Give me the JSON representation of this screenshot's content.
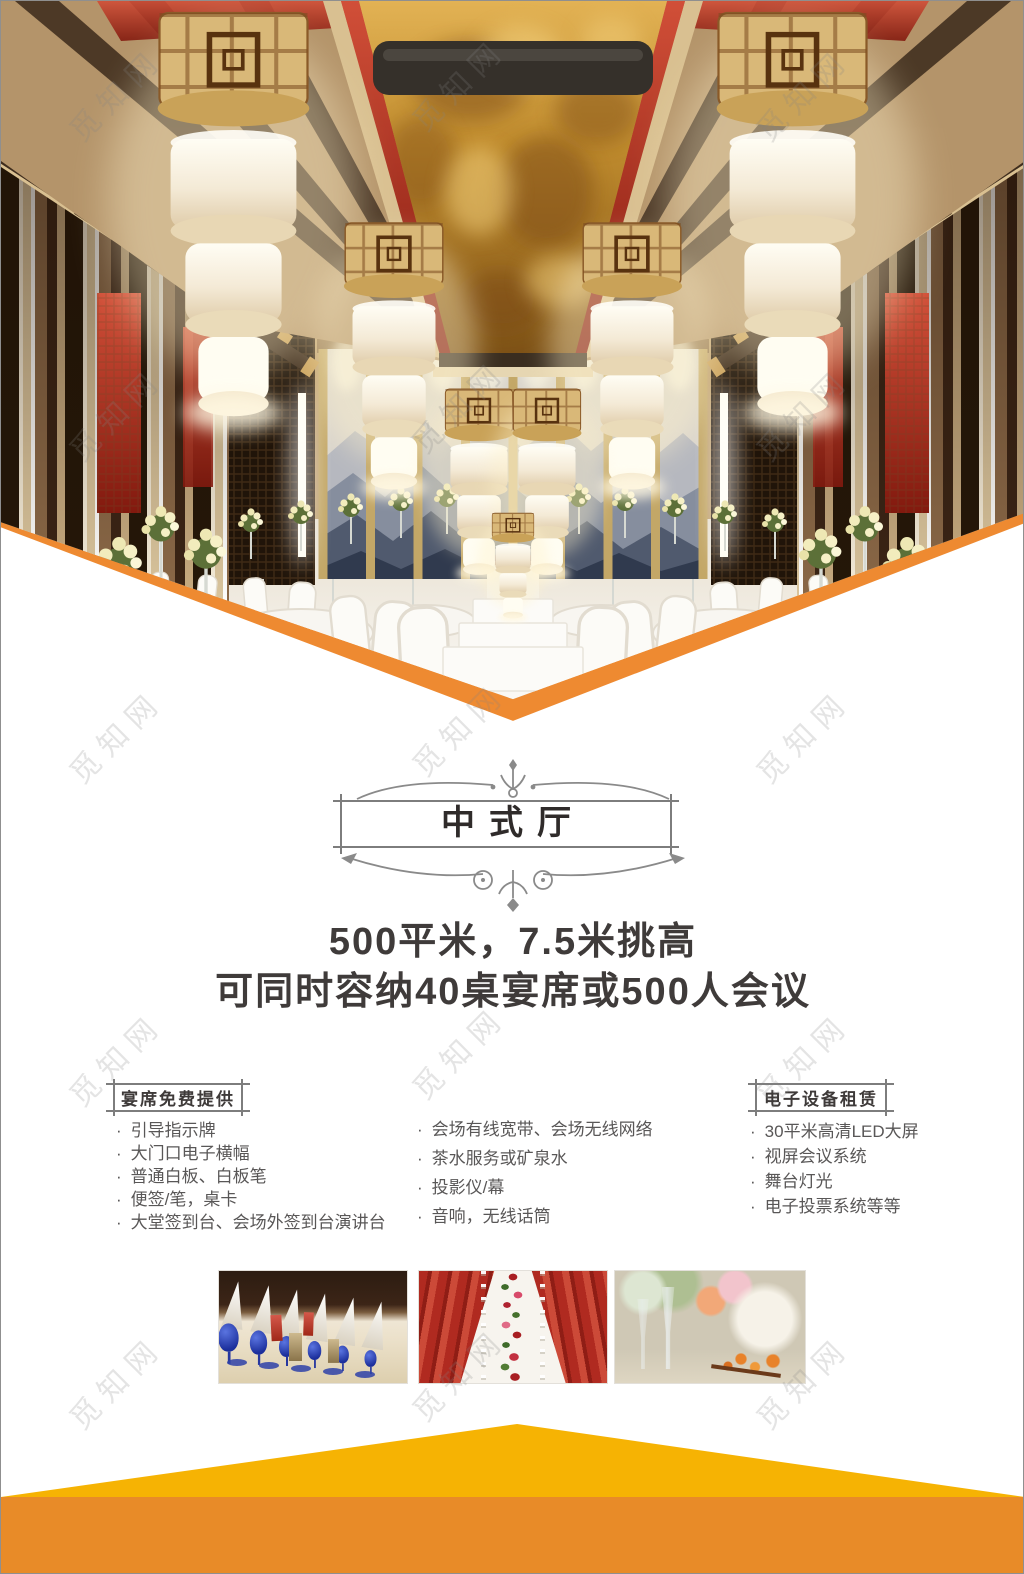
{
  "watermark": {
    "text": "觅知网"
  },
  "hero": {
    "image": "banquet-hall-ceiling-lanterns-photo"
  },
  "title_box": {
    "title": "中式厅"
  },
  "headline": {
    "line1": "500平米，7.5米挑高",
    "line2": "可同时容纳40桌宴席或500人会议"
  },
  "list_bullet": "·",
  "columns": {
    "free": {
      "header": "宴席免费提供",
      "items": [
        "引导指示牌",
        "大门口电子横幅",
        "普通白板、白板笔",
        "便签/笔，桌卡",
        "大堂签到台、会场外签到台演讲台"
      ]
    },
    "services": {
      "items": [
        "会场有线宽带、会场无线网络",
        "茶水服务或矿泉水",
        "投影仪/幕",
        "音响，无线话筒"
      ]
    },
    "rental": {
      "header": "电子设备租赁",
      "items": [
        "30平米高清LED大屏",
        "视屏会议系统",
        "舞台灯光",
        "电子投票系统等等"
      ]
    }
  },
  "gallery": {
    "photos": [
      {
        "name": "blue-goblet-table-setting-photo"
      },
      {
        "name": "red-chairs-floral-runner-photo"
      },
      {
        "name": "floral-centerpiece-closeup-photo"
      }
    ]
  },
  "colors": {
    "chevron_orange": "#ee8a31",
    "triangle_yellow": "#f6b303",
    "band_orange": "#e88b28",
    "heading_text": "#3f3b3a",
    "body_text": "#595757",
    "frame_line": "#7d7d7d",
    "watermark_grey": "#9a9a9a"
  }
}
